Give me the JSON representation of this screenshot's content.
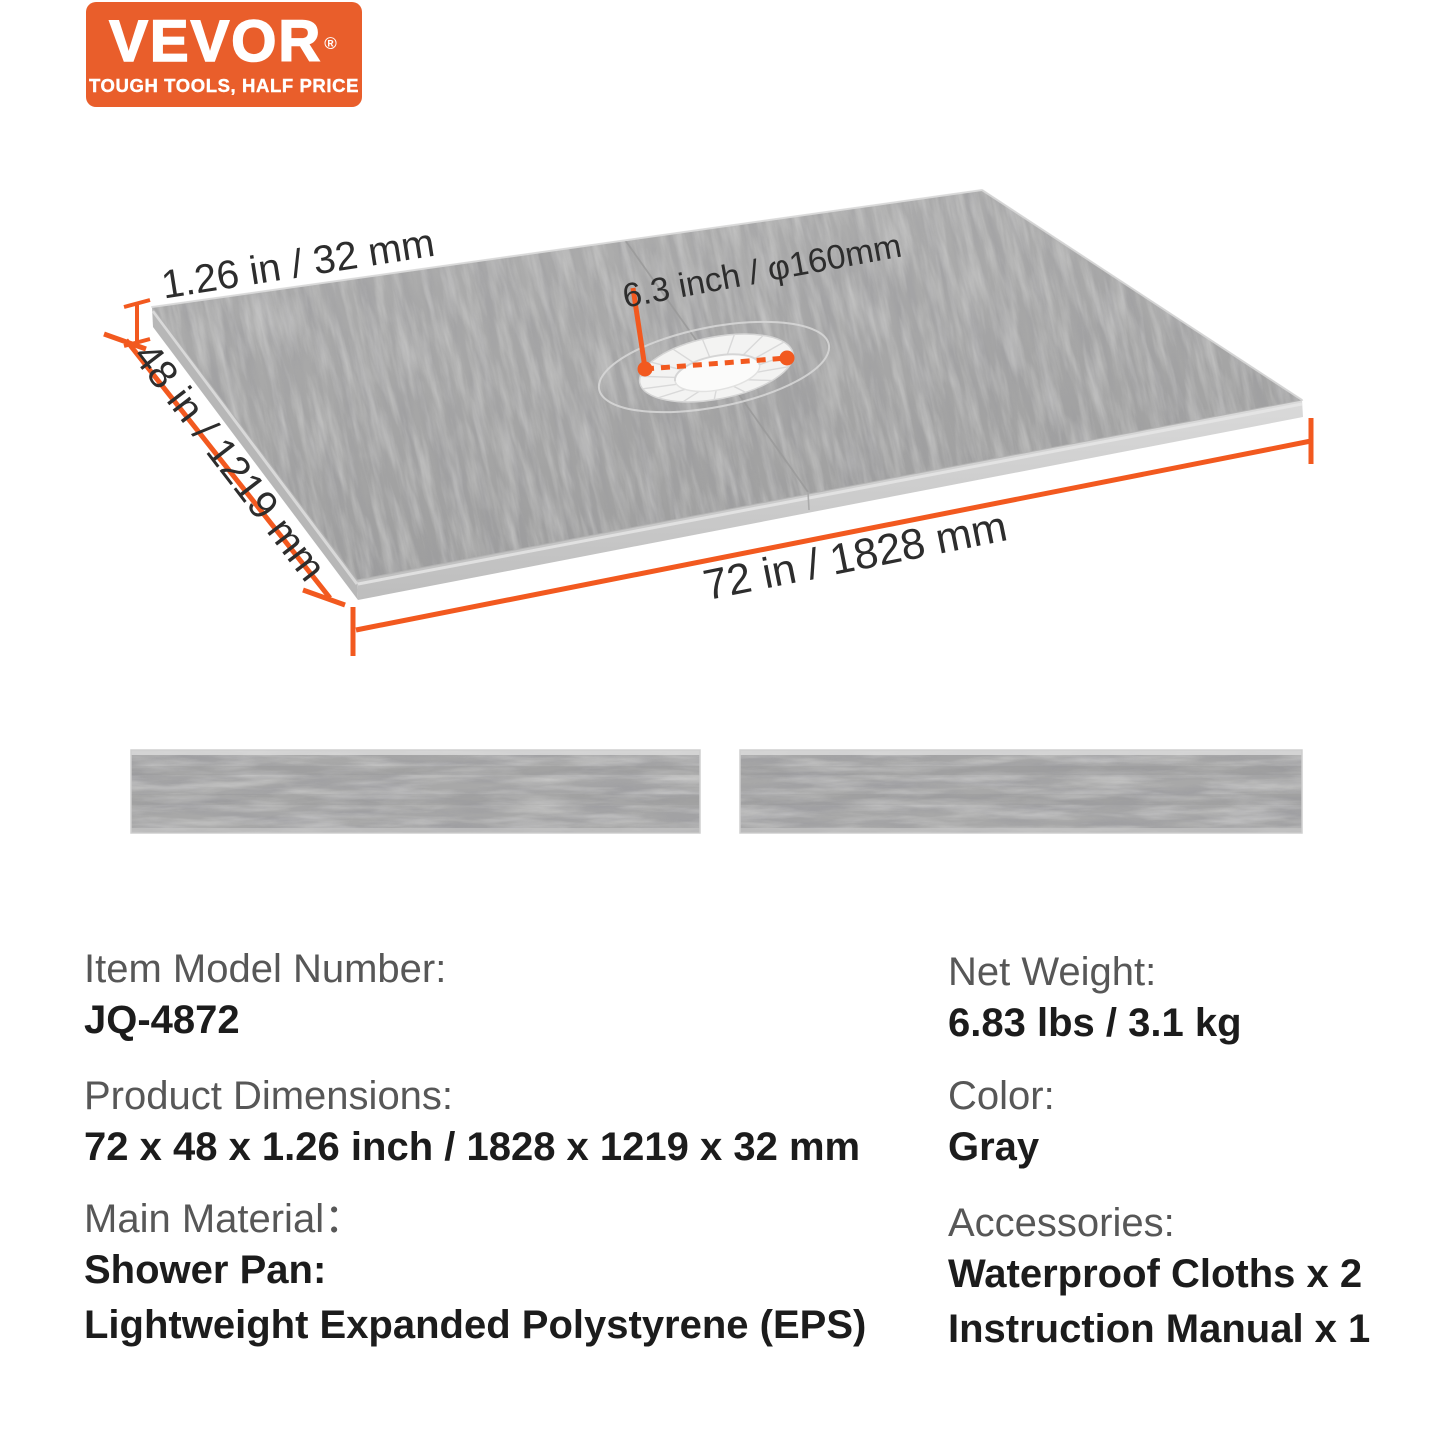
{
  "brand": {
    "logo_text": "VEVOR",
    "registered_mark": "®",
    "tagline": "TOUGH TOOLS, HALF PRICE",
    "orange": "#E95E2B"
  },
  "diagram": {
    "dim_thickness": "1.26 in / 32 mm",
    "dim_width": "48 in / 1219 mm",
    "dim_length": "72 in / 1828 mm",
    "dim_drain": "6.3 inch / φ160mm",
    "accent": "#F2591F",
    "pan_color": "#a6a6a6",
    "item": "shower-pan-with-center-drain-cutout",
    "strips": "curb-foam-strips x 2"
  },
  "specs": {
    "left": [
      {
        "label": "Item Model Number:",
        "lines": [
          "JQ-4872"
        ]
      },
      {
        "label": "Product Dimensions:",
        "lines": [
          "72 x 48 x 1.26 inch / 1828 x 1219 x 32 mm"
        ]
      },
      {
        "label": "Main Material：",
        "lines": [
          "Shower Pan:",
          "Lightweight Expanded Polystyrene (EPS)"
        ]
      }
    ],
    "right": [
      {
        "label": "Net Weight:",
        "lines": [
          "6.83 lbs / 3.1 kg"
        ]
      },
      {
        "label": "Color:",
        "lines": [
          "Gray"
        ]
      },
      {
        "label": "Accessories:",
        "lines": [
          "Waterproof Cloths x 2",
          "Instruction Manual x 1"
        ]
      }
    ]
  }
}
